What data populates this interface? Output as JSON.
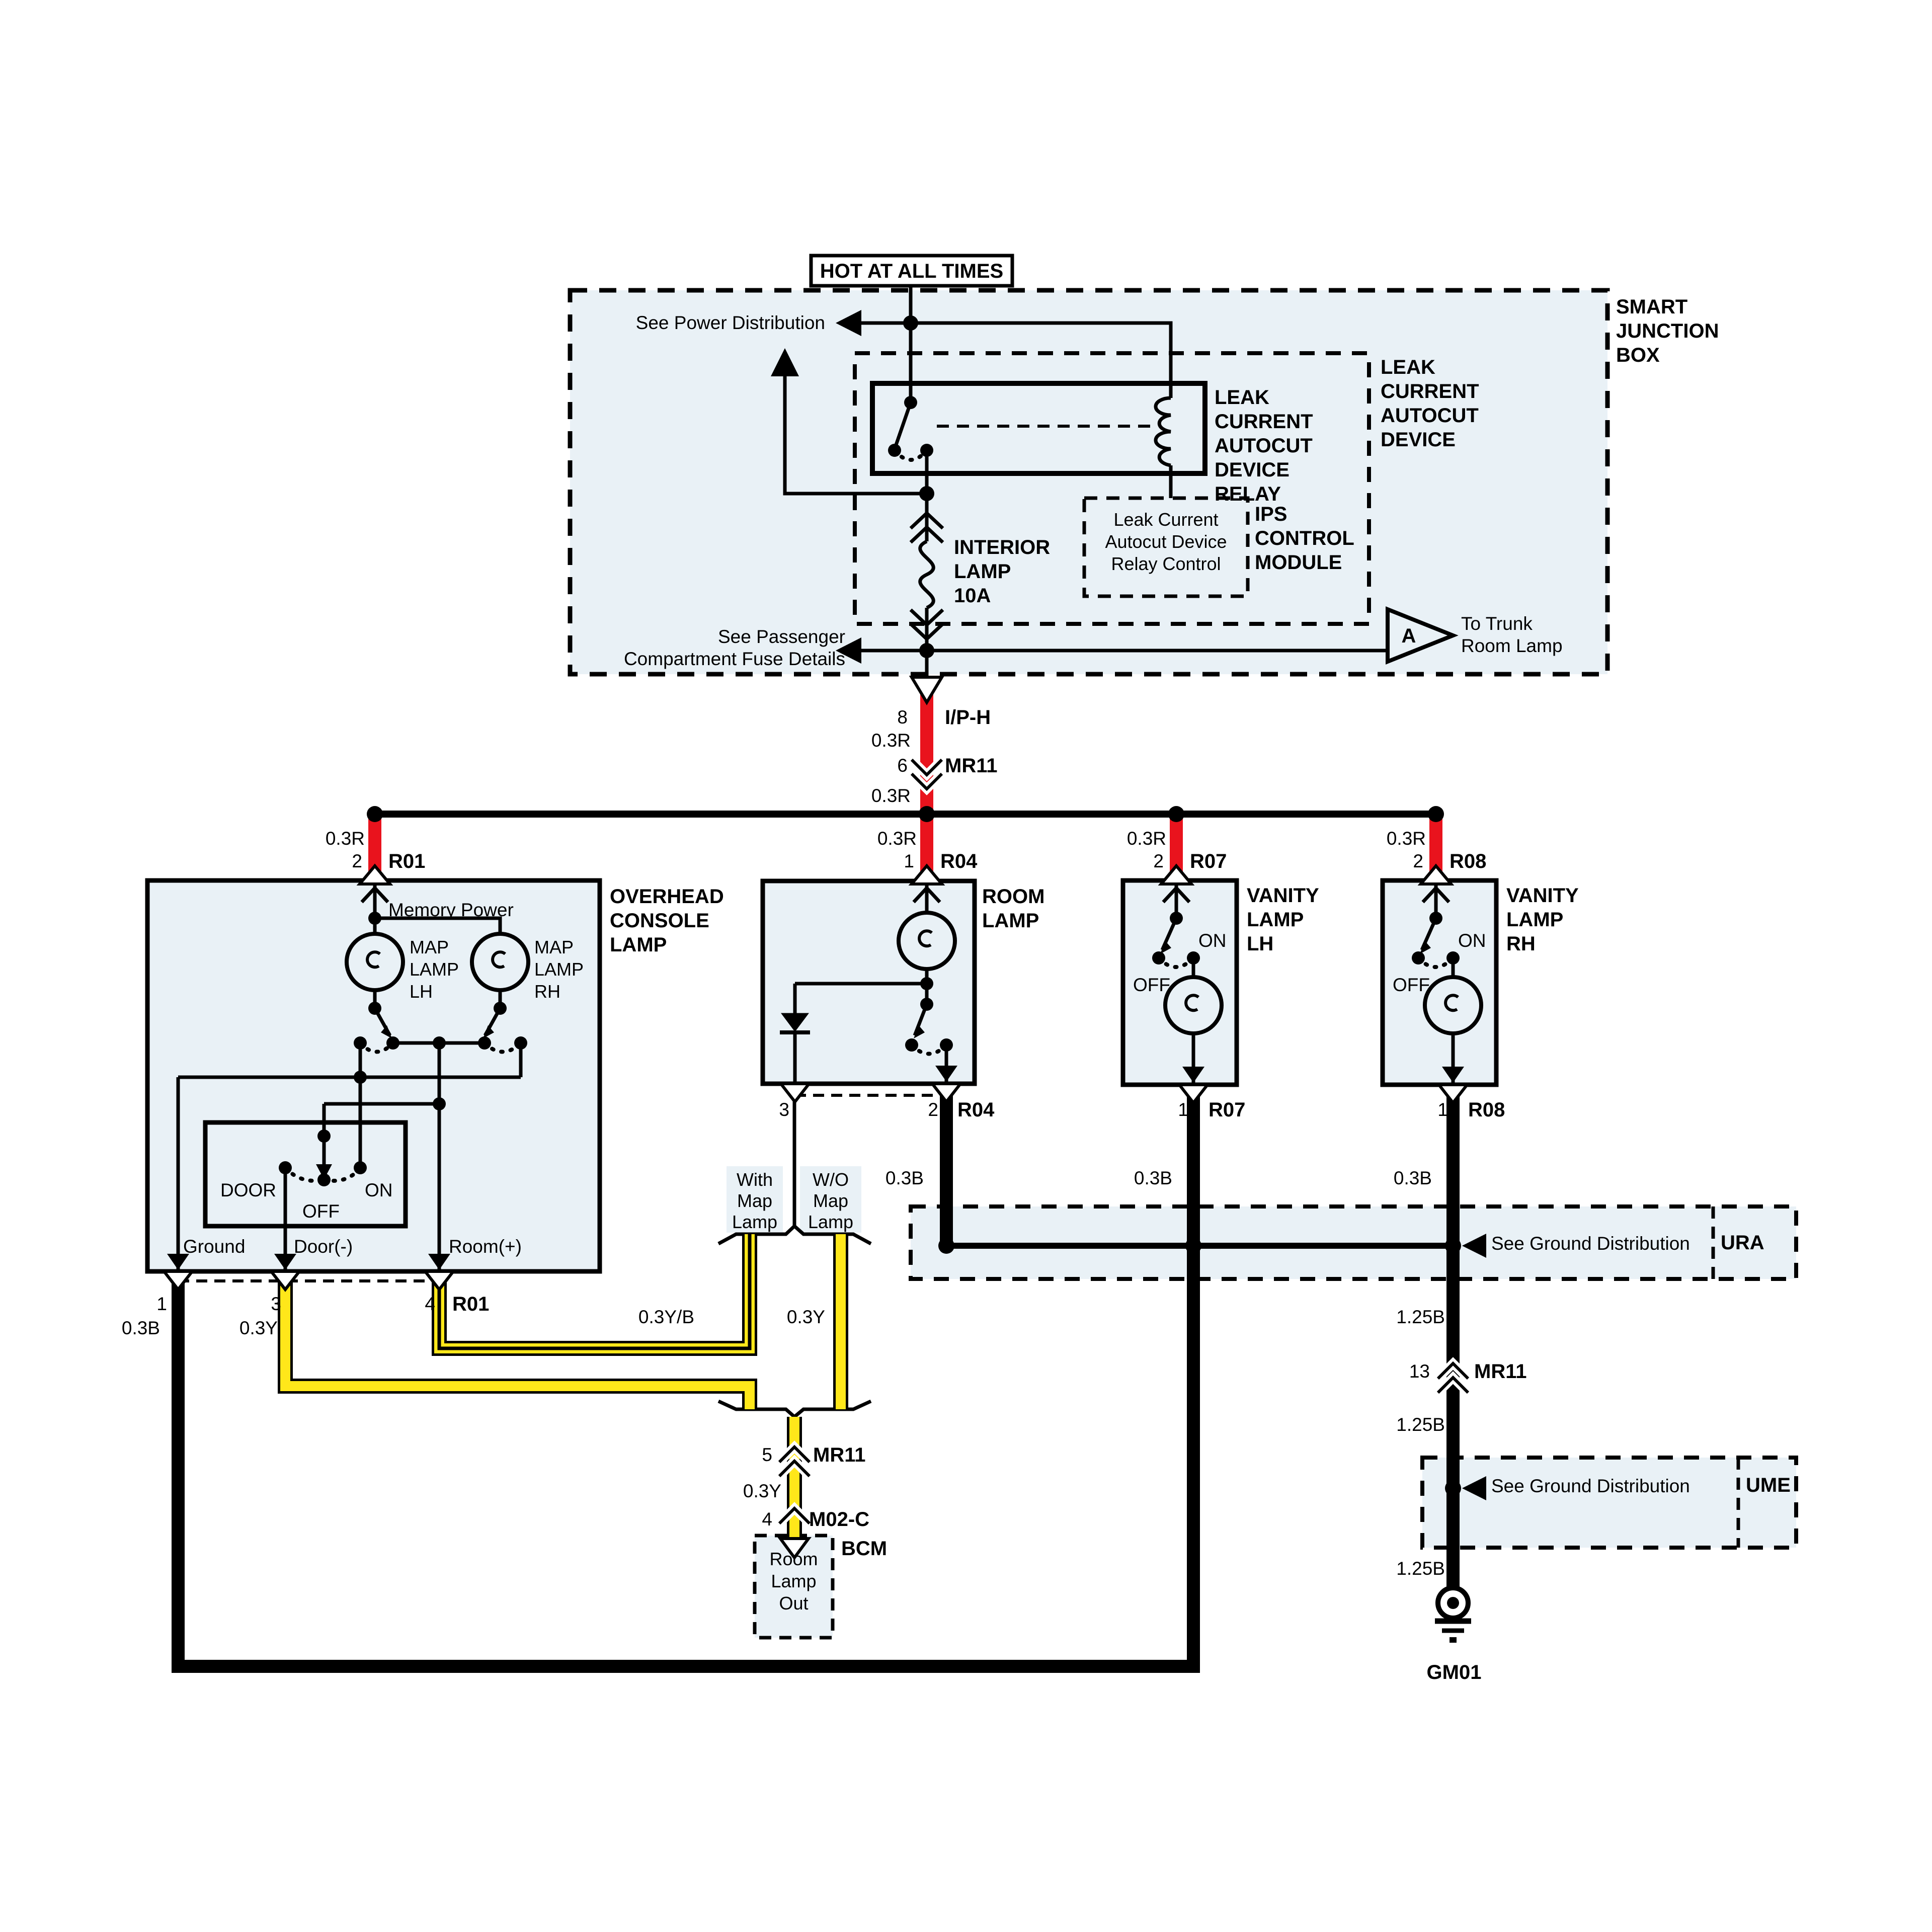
{
  "colors": {
    "wire_red": "#e9131d",
    "wire_yellow": "#ffe71a",
    "panel_fill": "#e9f1f6",
    "line": "#000000"
  },
  "power": {
    "hot_label": "HOT AT ALL TIMES",
    "see_power_distribution": "See Power Distribution",
    "smart_junction_box": [
      "SMART",
      "JUNCTION",
      "BOX"
    ],
    "relay_label": [
      "LEAK",
      "CURRENT",
      "AUTOCUT",
      "DEVICE",
      "RELAY"
    ],
    "autocut_device_label": [
      "LEAK",
      "CURRENT",
      "AUTOCUT",
      "DEVICE"
    ],
    "ips_label": [
      "IPS",
      "CONTROL",
      "MODULE"
    ],
    "ips_signal": [
      "Leak Current",
      "Autocut Device",
      "Relay Control"
    ],
    "fuse_label": [
      "INTERIOR",
      "LAMP",
      "10A"
    ],
    "see_passenger": [
      "See Passenger",
      "Compartment Fuse Details"
    ],
    "trunk_ref_letter": "A",
    "to_trunk": [
      "To Trunk",
      "Room Lamp"
    ]
  },
  "wire_labels": {
    "r": "0.3R",
    "b": "0.3B",
    "y": "0.3Y",
    "yb": "0.3Y/B",
    "b125": "1.25B"
  },
  "connectors": {
    "iph": {
      "pin": "8",
      "name": "I/P-H"
    },
    "mr11_6": {
      "pin": "6",
      "name": "MR11"
    },
    "mr11_5": {
      "pin": "5",
      "name": "MR11"
    },
    "mr11_13": {
      "pin": "13",
      "name": "MR11"
    },
    "m02c": {
      "pin": "4",
      "name": "M02-C"
    },
    "r01": {
      "feed_pin": "2",
      "ground_pin": "1",
      "door_pin": "3",
      "room_pin": "4",
      "name": "R01"
    },
    "r04": {
      "feed_pin": "1",
      "diode_pin": "3",
      "ground_pin": "2",
      "name": "R04"
    },
    "r07": {
      "feed_pin": "2",
      "ground_pin": "1",
      "name": "R07"
    },
    "r08": {
      "feed_pin": "2",
      "ground_pin": "1",
      "name": "R08"
    }
  },
  "console": {
    "label": [
      "OVERHEAD",
      "CONSOLE",
      "LAMP"
    ],
    "memory_power": "Memory Power",
    "map_lh": [
      "MAP",
      "LAMP",
      "LH"
    ],
    "map_rh": [
      "MAP",
      "LAMP",
      "RH"
    ],
    "door": "DOOR",
    "off": "OFF",
    "on": "ON",
    "ground": "Ground",
    "door_neg": "Door(-)",
    "room_pos": "Room(+)"
  },
  "room_lamp": {
    "label": [
      "ROOM",
      "LAMP"
    ]
  },
  "vanity_lh": {
    "label": [
      "VANITY",
      "LAMP",
      "LH"
    ],
    "on": "ON",
    "off": "OFF"
  },
  "vanity_rh": {
    "label": [
      "VANITY",
      "LAMP",
      "RH"
    ],
    "on": "ON",
    "off": "OFF"
  },
  "options": {
    "with_map": [
      "With",
      "Map",
      "Lamp"
    ],
    "wo_map": [
      "W/O",
      "Map",
      "Lamp"
    ]
  },
  "bcm": {
    "label": "BCM",
    "signal": [
      "Room",
      "Lamp",
      "Out"
    ]
  },
  "grounds": {
    "ura_text": "See Ground Distribution",
    "ura": "URA",
    "ume_text": "See Ground Distribution",
    "ume": "UME",
    "gm01": "GM01"
  }
}
